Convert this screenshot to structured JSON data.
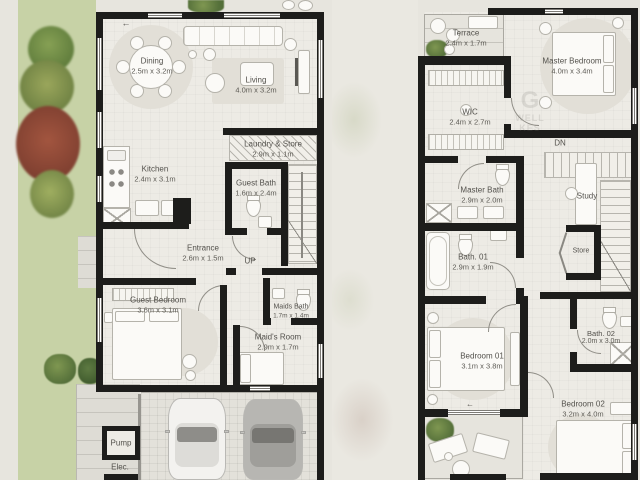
{
  "ground_floor": {
    "rooms": {
      "dining": {
        "name": "Dining",
        "dims": "2.5m x 3.2m"
      },
      "living": {
        "name": "Living",
        "dims": "4.0m x 3.2m"
      },
      "kitchen": {
        "name": "Kitchen",
        "dims": "2.4m x 3.1m"
      },
      "laundry_store": {
        "name": "Laundry & Store",
        "dims": "2.9m x 1.1m"
      },
      "guest_bath": {
        "name": "Guest Bath",
        "dims": "1.6m x 2.4m"
      },
      "entrance": {
        "name": "Entrance",
        "dims": "2.6m x 1.5m"
      },
      "guest_bedroom": {
        "name": "Guest Bedroom",
        "dims": "3.6m x 3.1m"
      },
      "maids_bath": {
        "name": "Maids Bath",
        "dims": "1.7m x 1.4m"
      },
      "maids_room": {
        "name": "Maid's Room",
        "dims": "2.9m x 1.7m"
      }
    },
    "labels": {
      "up": "UP",
      "pump": "Pump",
      "elec": "Elec."
    }
  },
  "first_floor": {
    "rooms": {
      "terrace": {
        "name": "Terrace",
        "dims": "2.4m x 1.7m"
      },
      "master_bedroom": {
        "name": "Master Bedroom",
        "dims": "4.0m x 3.4m"
      },
      "wic": {
        "name": "WIC",
        "dims": "2.4m x 2.7m"
      },
      "master_bath": {
        "name": "Master Bath",
        "dims": "2.9m x 2.0m"
      },
      "bath_01": {
        "name": "Bath. 01",
        "dims": "2.9m x 1.9m"
      },
      "bath_02": {
        "name": "Bath. 02",
        "dims": "2.0m x 3.0m"
      },
      "bedroom_01": {
        "name": "Bedroom 01",
        "dims": "3.1m x 3.8m"
      },
      "bedroom_02": {
        "name": "Bedroom 02",
        "dims": "3.2m x 4.0m"
      }
    },
    "labels": {
      "dn": "DN",
      "study": "Study",
      "store": "Store"
    }
  },
  "icons": {
    "entry_arrow": "←",
    "balcony_arrow": "←"
  },
  "watermark": {
    "glyph": "G",
    "line1": "WELL",
    "line2": "KES"
  },
  "colors": {
    "wall": "#1d1d1b",
    "garden": "#c7d2a6",
    "floor": "#edebe5",
    "foliage_red": "#a2553f"
  }
}
